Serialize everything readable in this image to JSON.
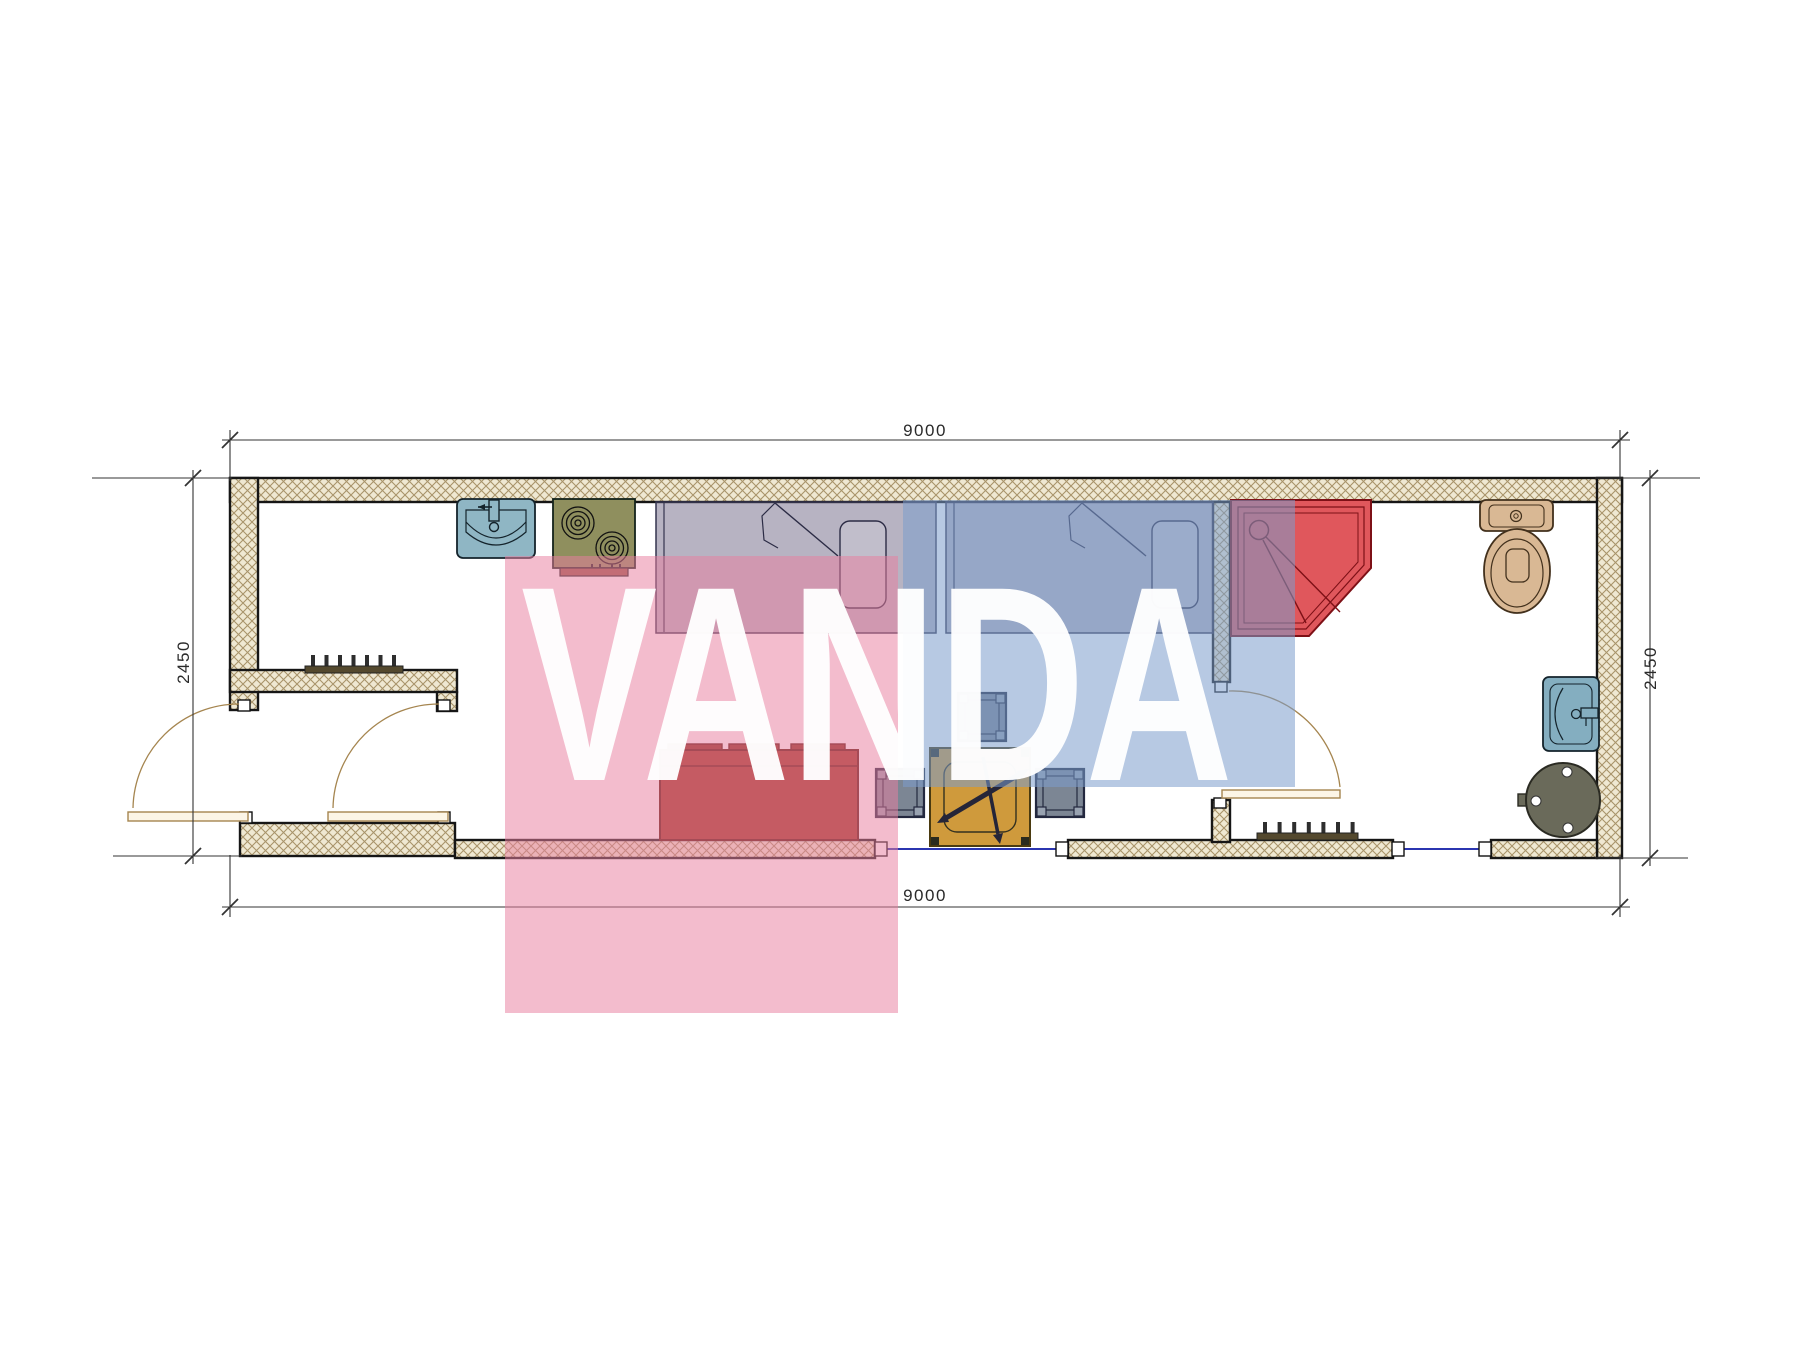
{
  "page": {
    "type": "architectural-floor-plan",
    "background": "#ffffff"
  },
  "dimensions": {
    "top_width": "9000",
    "bottom_width": "9000",
    "left_height": "2450",
    "right_height": "2450"
  },
  "watermark": {
    "text": "VANDA",
    "pink_color": "#e87f9f",
    "blue_color": "#7b9ccc",
    "text_color": "#ffffff"
  },
  "colors": {
    "wall_hatch_fill": "#efe8d2",
    "wall_hatch_line": "#a8946a",
    "wall_outline": "#161616",
    "door_line": "#a5854f",
    "window_line": "#2b35b0",
    "bed_fill": "rgba(84,74,110,0.42)",
    "sofa_red": "#a03522",
    "shower_red": "#e0575c",
    "stove_olive": "#8f8f5e",
    "sink_teal": "#8fb6c4",
    "toilet_tan": "#d9b894",
    "table_ochre": "#cf9a3c",
    "stool_gray": "#7c8694",
    "boiler_gray": "#6a6a5a",
    "dimension_line": "#333333"
  },
  "fixtures": {
    "kitchen": [
      "kitchen-sink",
      "stove-two-burners"
    ],
    "sleeping": [
      "bed-1",
      "bed-2"
    ],
    "living": [
      "sofa",
      "table",
      "stool-top",
      "stool-left",
      "stool-right"
    ],
    "bathroom": [
      "shower-pan",
      "toilet",
      "wall-sink",
      "boiler"
    ],
    "openings": [
      "entry-door",
      "hall-door",
      "bathroom-door",
      "window-1",
      "window-2"
    ],
    "heating": [
      "radiator-hall",
      "radiator-bottom"
    ]
  }
}
